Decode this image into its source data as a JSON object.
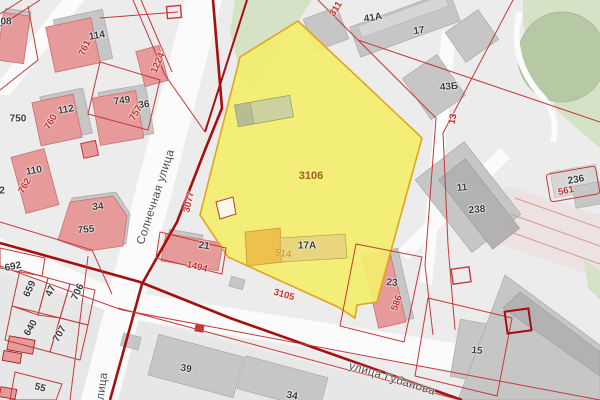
{
  "map": {
    "type": "cadastral-map-viewport",
    "highlighted_parcel": {
      "number": "3106",
      "building_address": "17A",
      "building_cadastral_number": "514"
    },
    "streets": [
      {
        "name": "Солнечная улица"
      },
      {
        "name": "улица Губанова"
      },
      {
        "name": "улица"
      }
    ],
    "colors": {
      "bg": "#ececec",
      "street": "#fbfbfb",
      "green": "#d6e2c6",
      "pond": "#b6c9a4",
      "pondEdge": "#a7bc95",
      "yellow": "#f3ee6d",
      "yellowBorder": "#dfa61d",
      "orangeBld": "#eec04c",
      "tanBld": "#e8d57e",
      "pink": "#e69a9a",
      "pinkDark": "#c87070",
      "gray": "#c6c6c6",
      "grayDark": "#b2b2b2",
      "grayLight": "#d6d6d6",
      "greenBld": "#ccd19e",
      "holeFill": "#fbf9ea",
      "red": "#c23b3b",
      "boldRed": "#a50f0f",
      "lavLine": "#d89898",
      "lavFill": "#ece2e2",
      "labelBlack": "#3a3a3a",
      "labelRed": "#c03030",
      "labelStreet": "#4d4d4d",
      "labelParcel": "#a05c28",
      "label514": "#dc9a24"
    },
    "labels": [
      {
        "name": "label-parcel-708",
        "text": "08",
        "x": 6,
        "y": 22,
        "rot": 0,
        "cls": "lb"
      },
      {
        "name": "label-building-114",
        "text": "114",
        "x": 97,
        "y": 36,
        "rot": -10,
        "cls": "lb"
      },
      {
        "name": "label-parcel-761",
        "text": "761",
        "x": 85,
        "y": 48,
        "rot": -65,
        "cls": "lr"
      },
      {
        "name": "label-building-112",
        "text": "112",
        "x": 66,
        "y": 110,
        "rot": -10,
        "cls": "lb"
      },
      {
        "name": "label-parcel-760",
        "text": "760",
        "x": 51,
        "y": 122,
        "rot": -60,
        "cls": "lr"
      },
      {
        "name": "label-parcel-750",
        "text": "750",
        "x": 18,
        "y": 119,
        "rot": 0,
        "cls": "lb"
      },
      {
        "name": "label-parcel-749",
        "text": "749",
        "x": 122,
        "y": 101,
        "rot": -8,
        "cls": "lb"
      },
      {
        "name": "label-building-36",
        "text": "36",
        "x": 144,
        "y": 105,
        "rot": -8,
        "cls": "lb"
      },
      {
        "name": "label-parcel-757",
        "text": "757",
        "x": 136,
        "y": 113,
        "rot": -60,
        "cls": "lr"
      },
      {
        "name": "label-building-110",
        "text": "110",
        "x": 34,
        "y": 171,
        "rot": -10,
        "cls": "lb"
      },
      {
        "name": "label-parcel-762",
        "text": "762",
        "x": 25,
        "y": 186,
        "rot": -60,
        "cls": "lr"
      },
      {
        "name": "label-parcel-2-partial",
        "text": "2",
        "x": 2,
        "y": 191,
        "rot": 0,
        "cls": "lb"
      },
      {
        "name": "label-building-34",
        "text": "34",
        "x": 98,
        "y": 207,
        "rot": -5,
        "cls": "lb"
      },
      {
        "name": "label-parcel-755",
        "text": "755",
        "x": 86,
        "y": 230,
        "rot": -5,
        "cls": "lb"
      },
      {
        "name": "label-parcel-1224",
        "text": "1224",
        "x": 158,
        "y": 63,
        "rot": -67,
        "cls": "lr"
      },
      {
        "name": "label-parcel-3077",
        "text": "3077",
        "x": 189,
        "y": 202,
        "rot": -78,
        "cls": "lr"
      },
      {
        "name": "street-solnechnaya",
        "text": "Солнечная улица",
        "x": 156,
        "y": 197,
        "rot": -72,
        "cls": "ls"
      },
      {
        "name": "label-parcel-311",
        "text": "311",
        "x": 336,
        "y": 9,
        "rot": -58,
        "cls": "lr"
      },
      {
        "name": "label-building-41a",
        "text": "41А",
        "x": 373,
        "y": 18,
        "rot": -10,
        "cls": "lb"
      },
      {
        "name": "label-parcel-17",
        "text": "17",
        "x": 419,
        "y": 31,
        "rot": -8,
        "cls": "lb"
      },
      {
        "name": "label-building-43b",
        "text": "43Б",
        "x": 449,
        "y": 87,
        "rot": -5,
        "cls": "lb"
      },
      {
        "name": "label-parcel-13",
        "text": "13",
        "x": 453,
        "y": 119,
        "rot": -80,
        "cls": "lr"
      },
      {
        "name": "label-parcel-3106",
        "text": "3106",
        "x": 311,
        "y": 176,
        "rot": 0,
        "cls": "lh"
      },
      {
        "name": "label-building-11",
        "text": "11",
        "x": 462,
        "y": 188,
        "rot": -5,
        "cls": "lb"
      },
      {
        "name": "label-parcel-238",
        "text": "238",
        "x": 477,
        "y": 210,
        "rot": -5,
        "cls": "lb"
      },
      {
        "name": "label-building-236",
        "text": "236",
        "x": 576,
        "y": 180,
        "rot": -10,
        "cls": "lb"
      },
      {
        "name": "label-parcel-561",
        "text": "561",
        "x": 566,
        "y": 191,
        "rot": -12,
        "cls": "lr"
      },
      {
        "name": "label-building-17a",
        "text": "17А",
        "x": 307,
        "y": 246,
        "rot": 0,
        "cls": "lb"
      },
      {
        "name": "label-building-514",
        "text": "514",
        "x": 283,
        "y": 254,
        "rot": 8,
        "cls": "lo"
      },
      {
        "name": "label-building-21",
        "text": "21",
        "x": 204,
        "y": 246,
        "rot": 8,
        "cls": "lb"
      },
      {
        "name": "label-parcel-1494",
        "text": "1494",
        "x": 197,
        "y": 267,
        "rot": 14,
        "cls": "lr"
      },
      {
        "name": "label-parcel-3105",
        "text": "3105",
        "x": 284,
        "y": 295,
        "rot": 16,
        "cls": "lr"
      },
      {
        "name": "label-building-23",
        "text": "23",
        "x": 392,
        "y": 283,
        "rot": 5,
        "cls": "lb"
      },
      {
        "name": "label-parcel-586",
        "text": "586",
        "x": 397,
        "y": 303,
        "rot": -70,
        "cls": "lr"
      },
      {
        "name": "label-parcel-692",
        "text": "692",
        "x": 13,
        "y": 267,
        "rot": -12,
        "cls": "lb"
      },
      {
        "name": "label-parcel-659",
        "text": "659",
        "x": 30,
        "y": 289,
        "rot": -65,
        "cls": "lb"
      },
      {
        "name": "label-parcel-47",
        "text": "47",
        "x": 51,
        "y": 291,
        "rot": -65,
        "cls": "lb"
      },
      {
        "name": "label-parcel-706",
        "text": "706",
        "x": 78,
        "y": 292,
        "rot": -65,
        "cls": "lb"
      },
      {
        "name": "label-parcel-640",
        "text": "640",
        "x": 31,
        "y": 328,
        "rot": -60,
        "cls": "lb"
      },
      {
        "name": "label-parcel-707",
        "text": "707",
        "x": 60,
        "y": 334,
        "rot": -60,
        "cls": "lb"
      },
      {
        "name": "label-parcel-55",
        "text": "55",
        "x": 40,
        "y": 388,
        "rot": 15,
        "cls": "lb"
      },
      {
        "name": "street-ulitsa-partial",
        "text": "улица",
        "x": 102,
        "y": 389,
        "rot": -82,
        "cls": "ls"
      },
      {
        "name": "label-building-39",
        "text": "39",
        "x": 186,
        "y": 369,
        "rot": 10,
        "cls": "lb"
      },
      {
        "name": "label-building-34-partial",
        "text": "34",
        "x": 292,
        "y": 396,
        "rot": 10,
        "cls": "lb"
      },
      {
        "name": "street-gubanova",
        "text": "улица Губанова",
        "x": 392,
        "y": 379,
        "rot": 17,
        "cls": "ls"
      },
      {
        "name": "label-building-15",
        "text": "15",
        "x": 477,
        "y": 351,
        "rot": 5,
        "cls": "lb"
      }
    ]
  }
}
